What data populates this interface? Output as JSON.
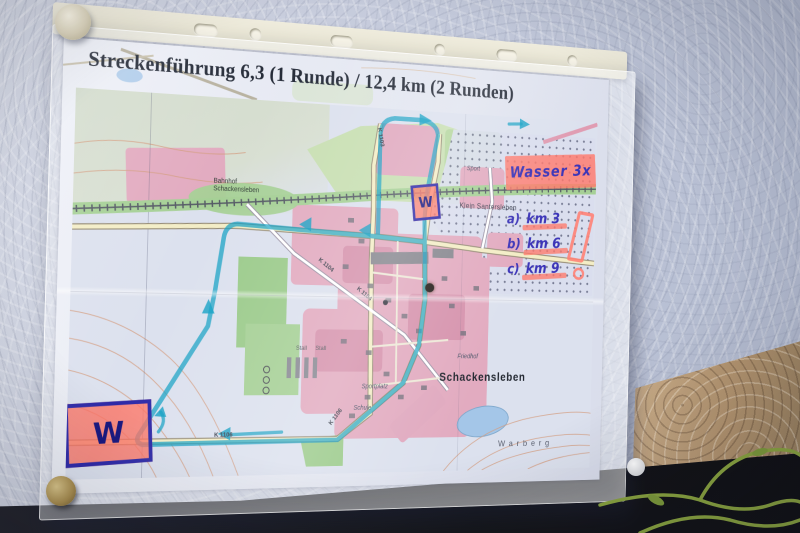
{
  "poster": {
    "title": "Streckenführung 6,3 (1 Runde) / 12,4 km (2 Runden)"
  },
  "handwritten": {
    "water_note": "Wasser 3x",
    "water_station": "W",
    "km_marks": [
      {
        "prefix": "a)",
        "text": "km 3"
      },
      {
        "prefix": "b)",
        "text": "km 6"
      },
      {
        "prefix": "c)",
        "text": "km 9"
      }
    ]
  },
  "map": {
    "labels": {
      "town": "Schackensleben",
      "village": "Klein Santersleben",
      "station_line1": "Bahnhof",
      "station_line2": "Schackensleben",
      "cemetery": "Friedhof",
      "sport": "Sport",
      "sports_field": "Sportplatz",
      "school": "Schule",
      "stables": "Stall Stall",
      "hill": "Warberg"
    },
    "roads": [
      "K 1103",
      "K 1104",
      "K 1104",
      "K 1106",
      "K 1106"
    ]
  },
  "colors": {
    "route": "#12a0c4",
    "marker_ink": "#3c35b8",
    "highlighter": "#ff7a6c",
    "builtup": "#e2abc0",
    "greenland": "#a6d096",
    "water": "#a4c6e8"
  }
}
